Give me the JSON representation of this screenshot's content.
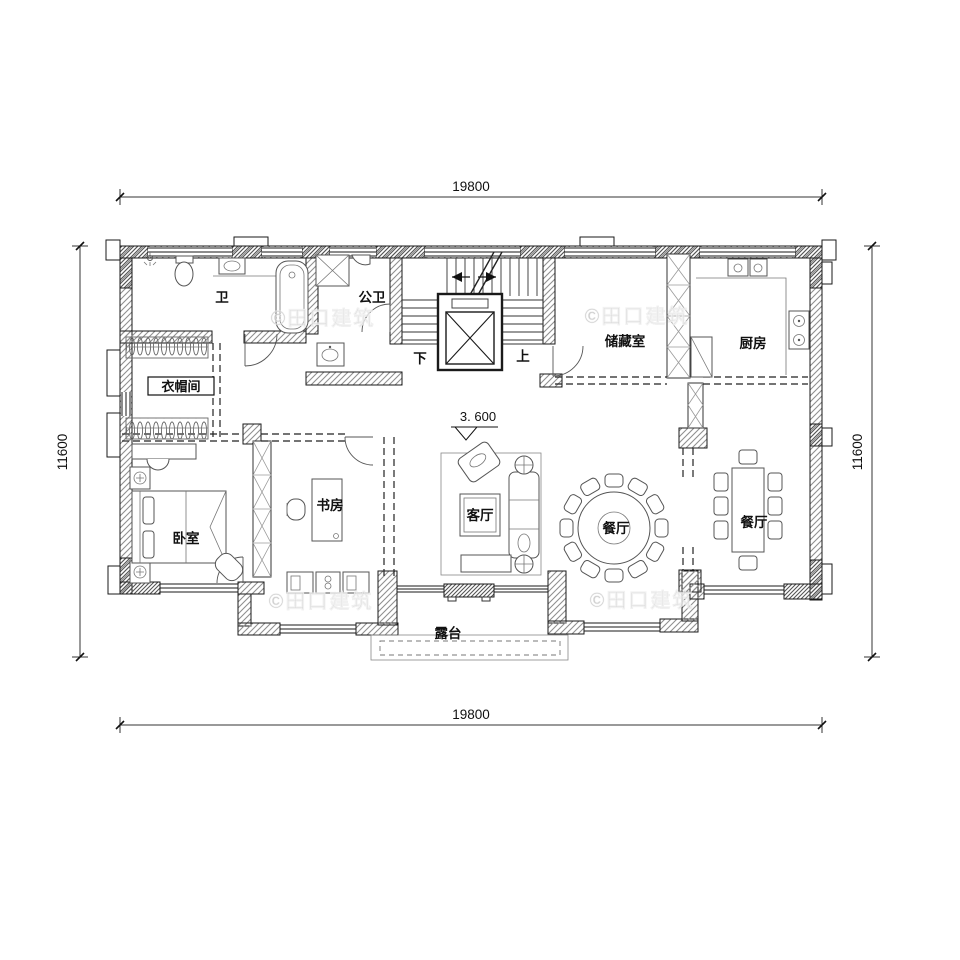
{
  "meta": {
    "drawing_type": "residential floor plan, second storey"
  },
  "dimensions": {
    "top": "19800",
    "bottom": "19800",
    "left": "11600",
    "right": "11600"
  },
  "elevation": "3. 600",
  "stairs": {
    "down": "下",
    "up": "上"
  },
  "rooms": {
    "bath": "卫",
    "public_bath": "公卫",
    "cloakroom": "衣帽间",
    "storage": "储藏室",
    "kitchen": "厨房",
    "study": "书房",
    "living": "客厅",
    "dining_round": "餐厅",
    "dining": "餐厅",
    "bedroom": "卧室",
    "terrace": "露台"
  },
  "watermark": "©田口建筑",
  "colors": {
    "line": "#1a1a1a",
    "wall_hatch": "#8a8a8a",
    "watermark": "#c8c8c8",
    "background": "#ffffff"
  }
}
